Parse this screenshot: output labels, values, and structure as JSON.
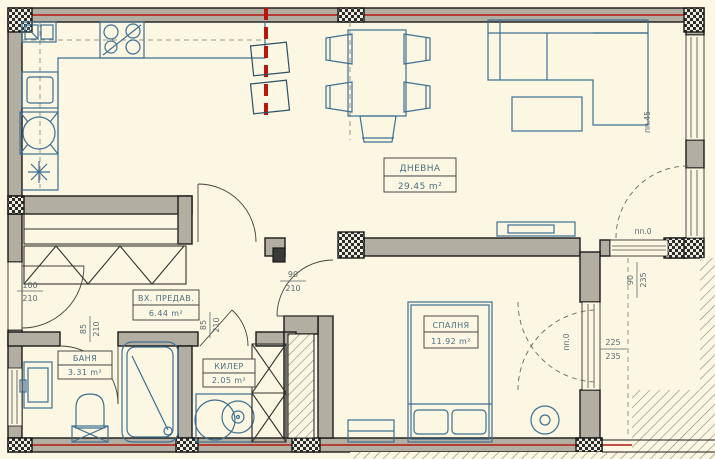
{
  "rooms": {
    "living": {
      "name": "ДНЕВНА",
      "area": "29.45 m²"
    },
    "bedroom": {
      "name": "СПАЛНЯ",
      "area": "11.92 m²"
    },
    "hall": {
      "name": "ВХ. ПРЕДАВ.",
      "area": "6.44 m²"
    },
    "bath": {
      "name": "БАНЯ",
      "area": "3.31 m²"
    },
    "closet": {
      "name": "КИЛЕР",
      "area": "2.05 m²"
    }
  },
  "dimensions": {
    "entrance_door": {
      "w": "100",
      "h": "210"
    },
    "bedroom_door": {
      "w": "90",
      "h": "210"
    },
    "bath_door": {
      "w": "85",
      "h": "210"
    },
    "closet_door": {
      "w": "85",
      "h": "210"
    },
    "balcony_window": {
      "w": "90",
      "h": "235"
    },
    "terrace_door": {
      "w": "225",
      "h": "235"
    },
    "sill_right": "пп.45",
    "sill_top": "пп.0",
    "sill_terrace": "пп.0"
  },
  "colors": {
    "background": "#fcf7e2",
    "wall": "#b3aea2",
    "outline": "#1b1b1b",
    "furniture": "#3e6f92",
    "red_line": "#b5180f",
    "hatch": "#8d8877"
  }
}
